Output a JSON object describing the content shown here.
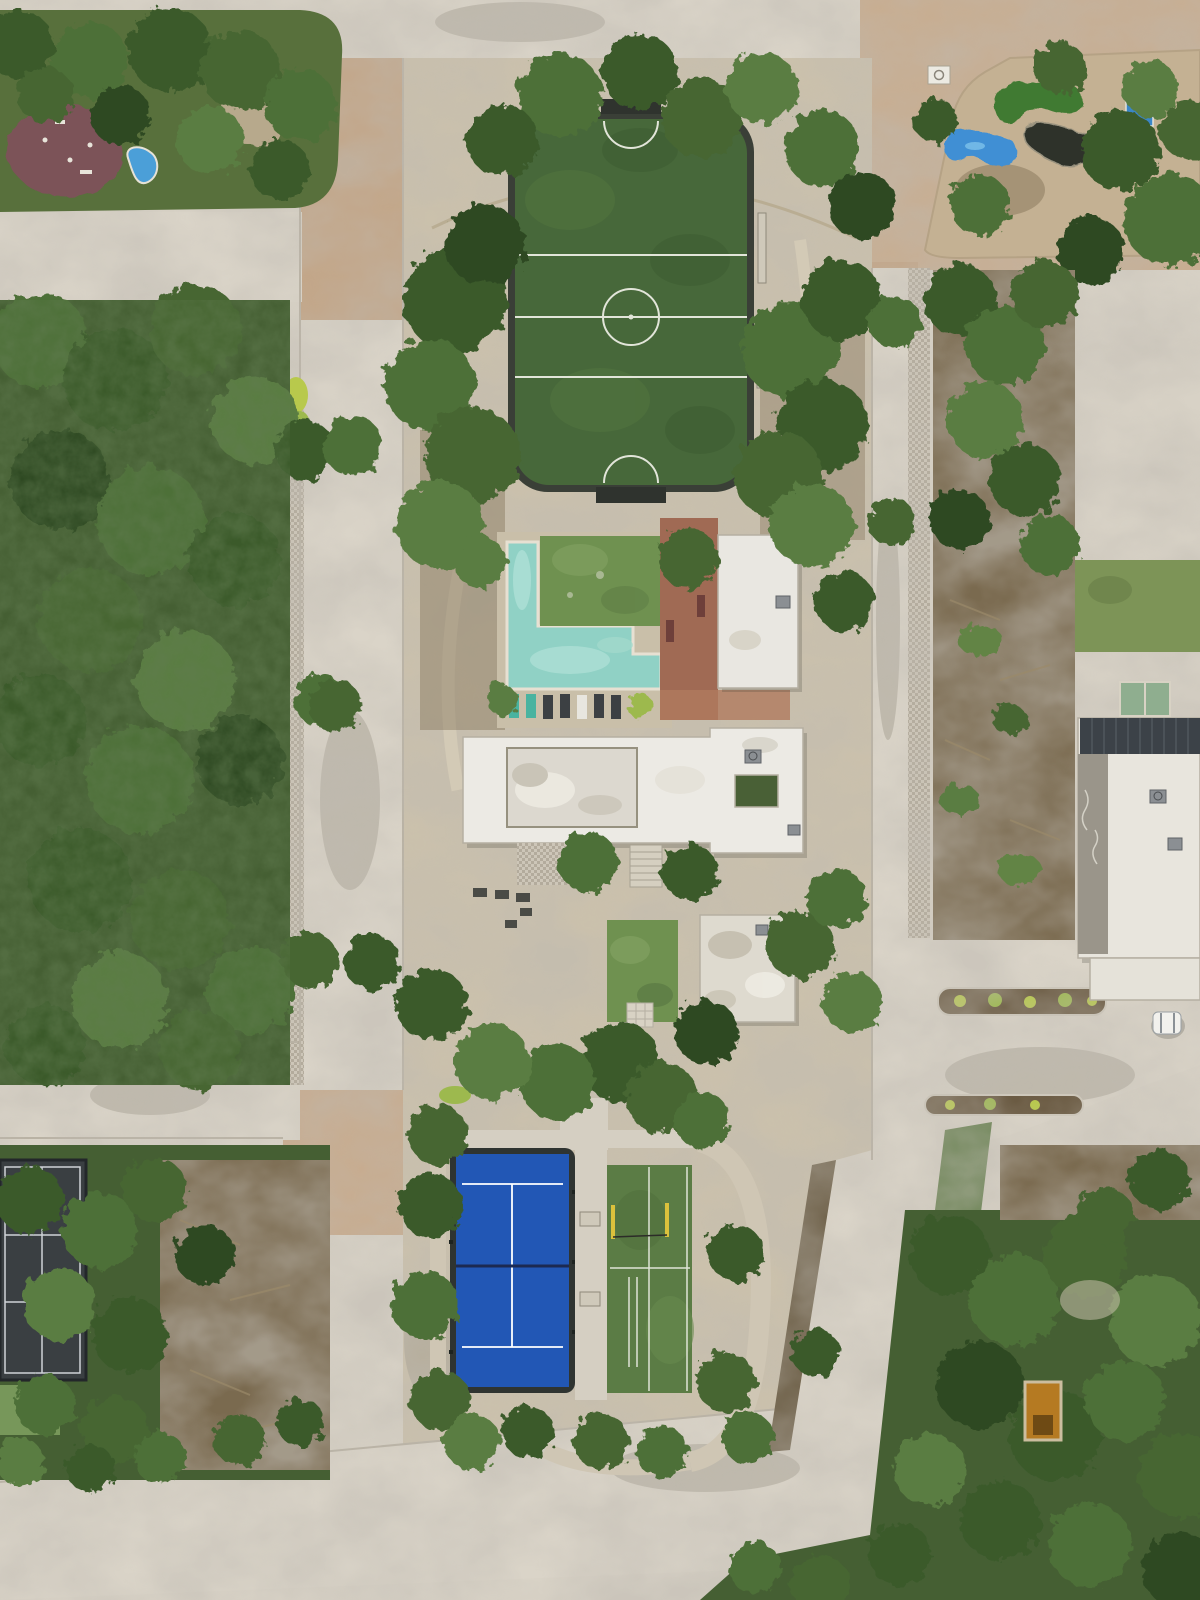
{
  "scene": {
    "type": "aerial-drone-photograph",
    "description": "Top-down drone view of a residential community amenity core: soccer field, L-shaped pool, clubhouse, padel court and training turf surrounded by jungle blocks and concrete streets",
    "road_marking_text": "o n"
  },
  "features": {
    "soccer_field": {
      "name": "soccer-field",
      "turf_color": "#47683a",
      "fence_color": "#3a3f37",
      "line_color": "#e2e5d9"
    },
    "swimming_pool": {
      "name": "l-shaped-pool",
      "water_color": "#90d1c5",
      "water_light": "#b2e2d8",
      "coping_color": "#e7e0d2"
    },
    "padel_court": {
      "name": "padel-court",
      "surface_color": "#2257b5",
      "fence_color": "#2f3431",
      "net_color": "#1c2a52"
    },
    "training_turf": {
      "name": "training-turf",
      "surface_color": "#5b7c45",
      "pole_color": "#dcc13c"
    },
    "tennis_court": {
      "name": "dark-court",
      "surface_color": "#3a3f42"
    },
    "mini_golf": {
      "green_color": "#3f7a33",
      "pond_color": "#3f8fd4",
      "dark_shape_color": "#2d322c",
      "splash_pool_color": "#3a86c8",
      "island_color": "#c4b193"
    },
    "kids_pool_color": "#4b9fd8",
    "playground_color": "#7b5258",
    "clubhouse_roof_color": "#eceae4",
    "poolhouse_roof_color": "#e9e7e1",
    "gym_roof_color": "#dedacf",
    "solar_panel_color": "#3c4248",
    "right_building_pool_color": "#8fae8f",
    "road_color": "#d8d2c6",
    "paver_road_color": "#c8ad90",
    "campus_ground_color": "#cbc1ac",
    "terracotta_color": "#a06a54",
    "lawn_color": "#6f9150",
    "forest_base_color": "#455f33",
    "car_color": "#f2f1ed",
    "planter_color": "#b57a22"
  }
}
